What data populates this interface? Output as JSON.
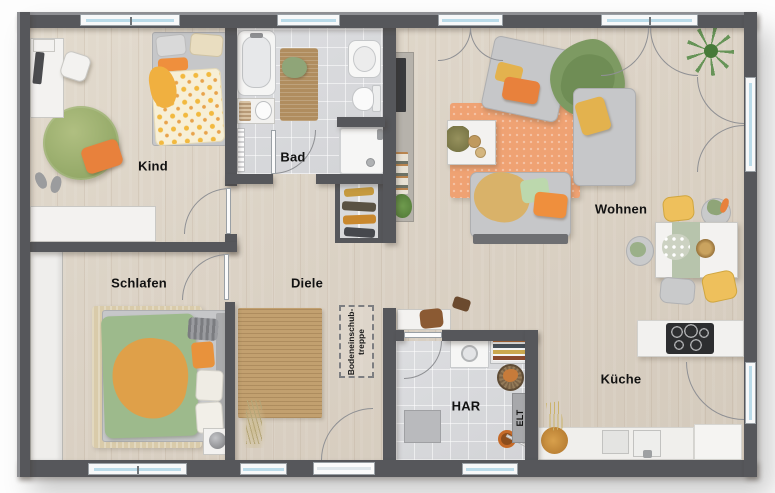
{
  "rooms": {
    "kind": {
      "label": "Kind"
    },
    "bad": {
      "label": "Bad"
    },
    "wohnen": {
      "label": "Wohnen"
    },
    "schlafen": {
      "label": "Schlafen"
    },
    "diele": {
      "label": "Diele"
    },
    "kueche": {
      "label": "Küche"
    },
    "har": {
      "label": "HAR"
    }
  },
  "annotations": {
    "elt": {
      "label": "ELT"
    },
    "attic_stairs": {
      "line1": "Bodeneinschub-",
      "line2": "treppe"
    }
  },
  "colors": {
    "wall": "#56575b",
    "wood_floor": "#dbd2c5",
    "tile_floor": "#d8d9db",
    "window_glass": "#badbe9",
    "accent_orange": "#e8813c",
    "accent_yellow": "#eec05c",
    "accent_green": "#87a56c",
    "rug_orange": "#efa273",
    "rug_jute": "#c2a06f",
    "rug_green": "#a3b471"
  }
}
